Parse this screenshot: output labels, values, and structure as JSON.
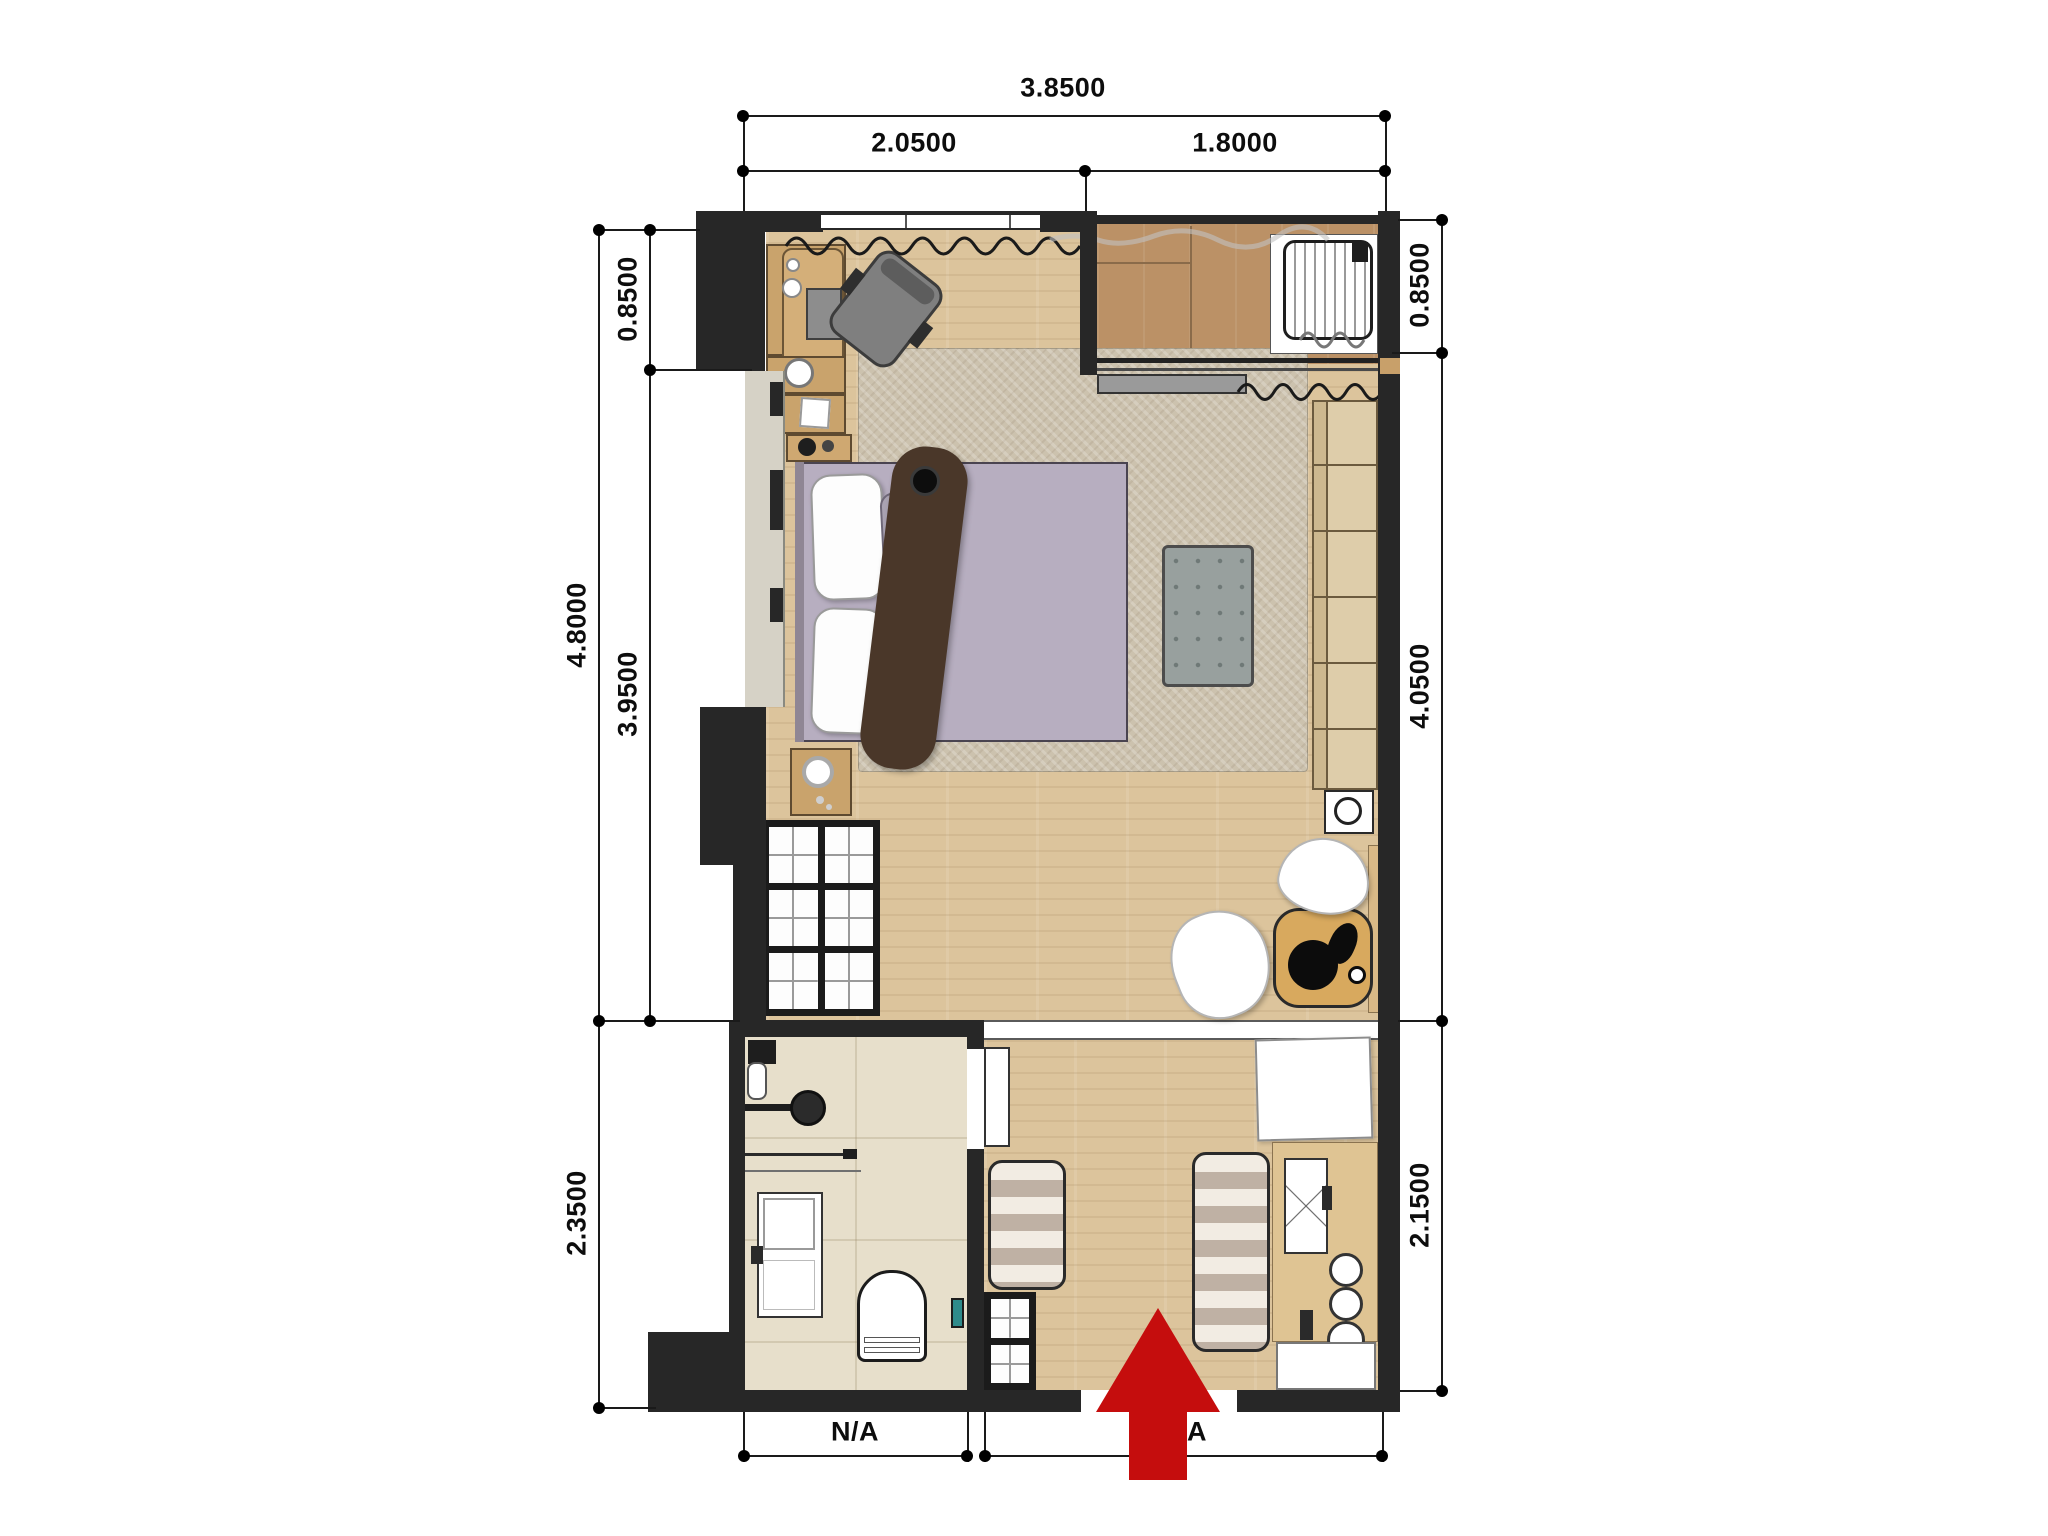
{
  "drawing": {
    "type": "apartment-floor-plan",
    "dimensions": {
      "top": {
        "total": "3.8500",
        "left_segment": "2.0500",
        "right_segment": "1.8000"
      },
      "left": {
        "overall": "4.8000",
        "upper": "0.8500",
        "middle": "3.9500",
        "lower": "2.3500"
      },
      "right": {
        "upper": "0.8500",
        "middle": "4.0500",
        "lower": "2.1500"
      },
      "bottom": {
        "left_segment": "N/A",
        "right_segment": "N/A"
      }
    },
    "entrance_arrow": {
      "direction": "up",
      "color": "#c50d0d"
    },
    "colors": {
      "wall": "#272727",
      "wood_floor": "#dcc49c",
      "balcony_floor": "#bb9166",
      "bathroom_floor": "#e7dfcb",
      "rug": "#ccc2ae",
      "bed": "#b7aec0",
      "furniture_wood": "#c9a36c",
      "wardrobe_wood": "#decdaa",
      "arrow_red": "#c50d0d"
    }
  }
}
